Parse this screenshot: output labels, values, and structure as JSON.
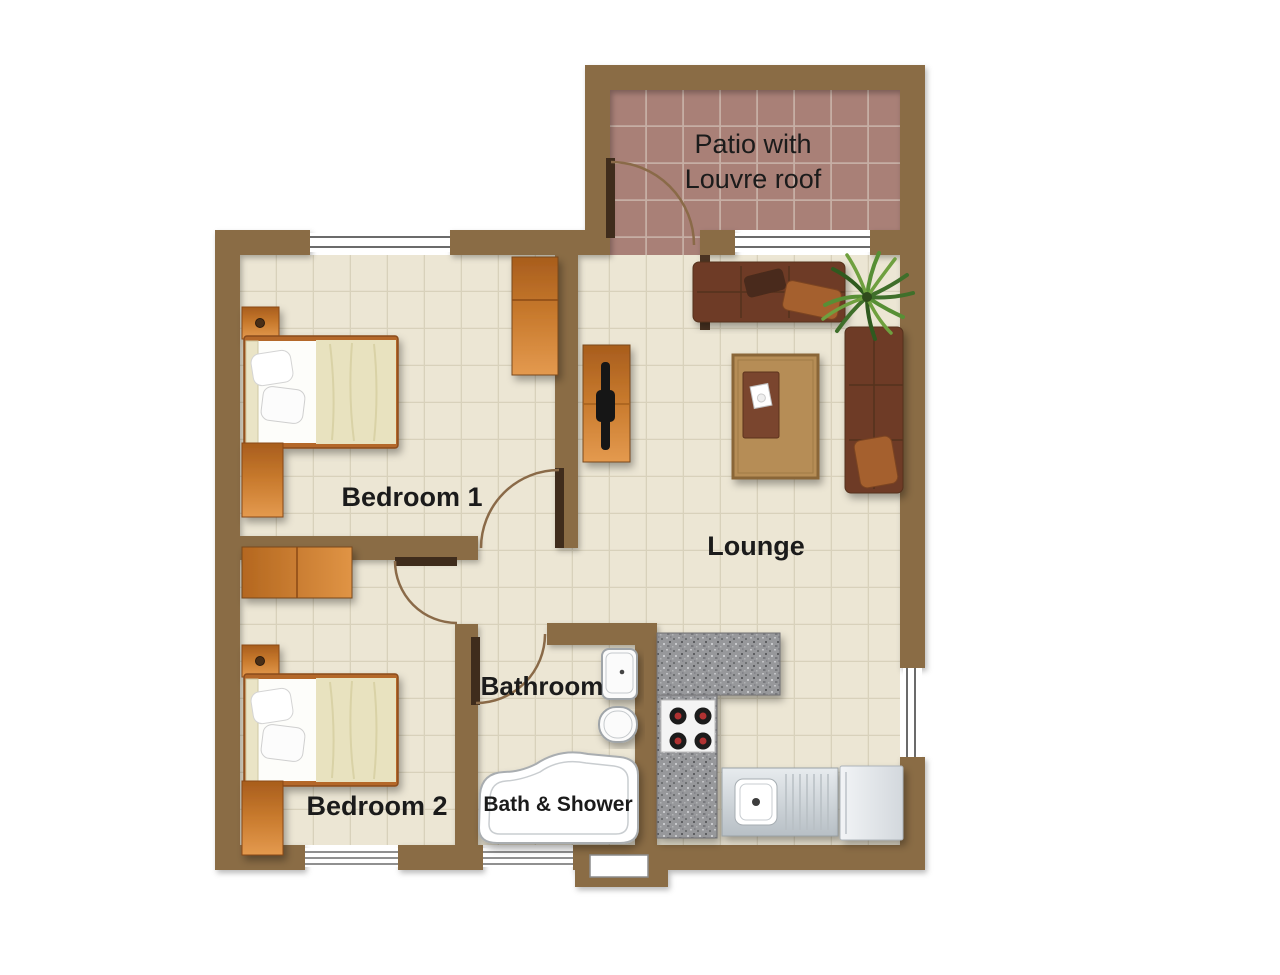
{
  "rooms": {
    "patio": {
      "line1": "Patio with",
      "line2": "Louvre roof"
    },
    "bedroom1": {
      "label": "Bedroom 1"
    },
    "lounge": {
      "label": "Lounge"
    },
    "bedroom2": {
      "label": "Bedroom 2"
    },
    "bathroom": {
      "label": "Bathroom"
    },
    "bath_shower": {
      "label": "Bath & Shower"
    }
  },
  "colors": {
    "wall": "#8a6c45",
    "door_leaf": "#3f2c1c",
    "door_arc": "#8a6a48",
    "floor": "#ece6d4",
    "floor_grid": "#d8d1bb",
    "patio_floor": "#a98077",
    "patio_grid": "#c6aea4",
    "label_text": "#1b1b1b",
    "wood_light": "#e49a4f",
    "wood_dark": "#a85d1d",
    "sofa": "#6e3b25",
    "cushion": "#a5602f",
    "rug": "#b68d57",
    "coffee_table": "#7a452d",
    "granite": "#97989b",
    "steel": "#ccd3d8",
    "fixture_white": "#fbfbfb",
    "plant_green": "#4e7f30",
    "burner_ring": "#1a1a1a",
    "burner_center": "#b03030",
    "window_line": "#6b6b6b"
  }
}
